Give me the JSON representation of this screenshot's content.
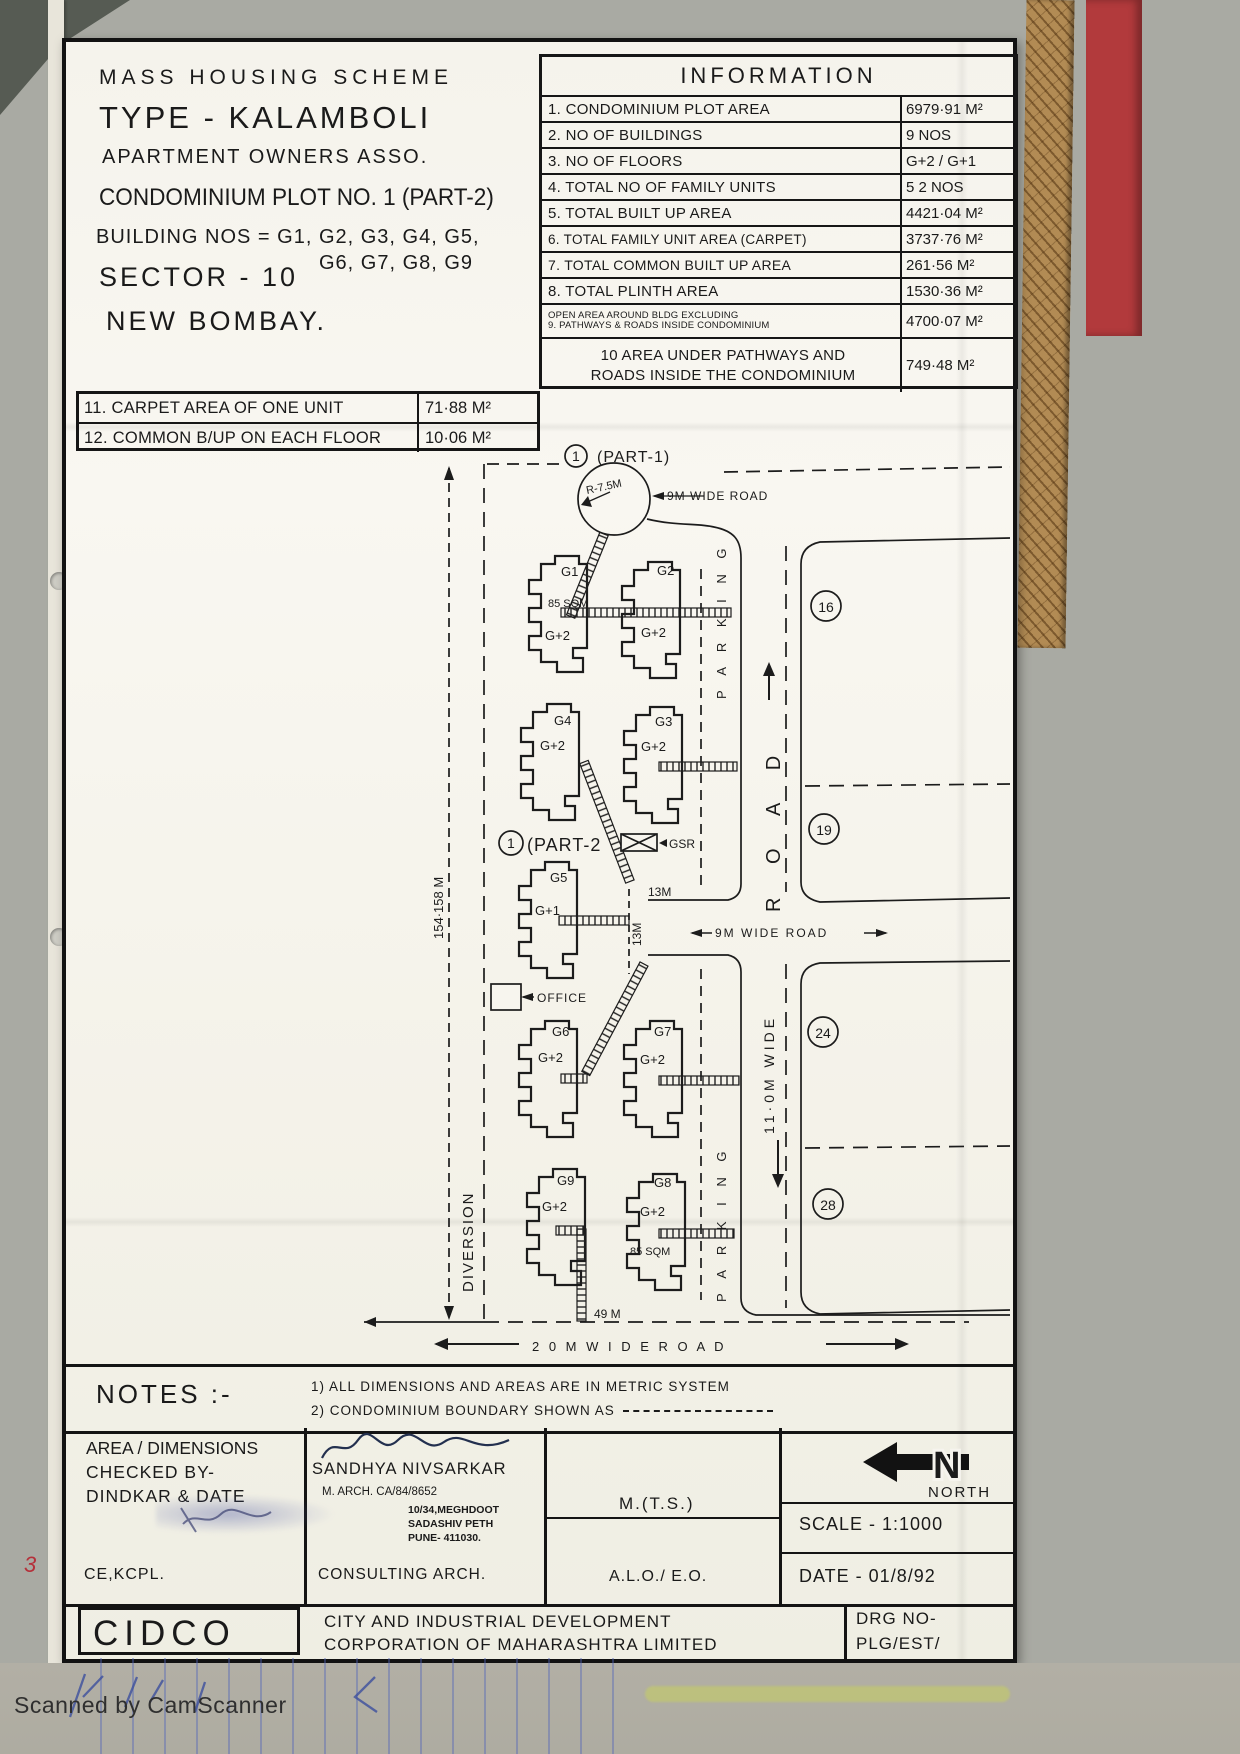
{
  "header": {
    "scheme": "MASS  HOUSING  SCHEME",
    "type": "TYPE - KALAMBOLI",
    "assoc": "APARTMENT  OWNERS   ASSO.",
    "condo": "CONDOMINIUM  PLOT NO. 1 (PART-2)",
    "building_nos": "BUILDING   NOS = G1, G2, G3, G4, G5,",
    "building_nos2": "G6, G7, G8, G9",
    "sector": "SECTOR - 10",
    "city": "NEW  BOMBAY."
  },
  "information": {
    "title": "INFORMATION",
    "rows": [
      {
        "label": "1. CONDOMINIUM  PLOT  AREA",
        "value": "6979·91 M²"
      },
      {
        "label": "2. NO  OF  BUILDINGS",
        "value": "9  NOS"
      },
      {
        "label": "3. NO  OF  FLOORS",
        "value": "G+2 / G+1"
      },
      {
        "label": "4. TOTAL  NO  OF  FAMILY UNITS",
        "value": "5 2  NOS"
      },
      {
        "label": "5. TOTAL  BUILT  UP  AREA",
        "value": "4421·04 M²"
      },
      {
        "label": "6. TOTAL FAMILY UNIT AREA (CARPET)",
        "value": "3737·76 M²"
      },
      {
        "label": "7. TOTAL  COMMON  BUILT UP  AREA",
        "value": "261·56 M²"
      },
      {
        "label": "8. TOTAL  PLINTH  AREA",
        "value": "1530·36 M²"
      }
    ],
    "row9": {
      "l1": "OPEN AREA AROUND BLDG EXCLUDING",
      "l2": "9. PATHWAYS & ROADS INSIDE CONDOMINIUM",
      "value": "4700·07 M²"
    },
    "row10": {
      "l1": "10  AREA  UNDER  PATHWAYS  AND",
      "l2": "ROADS INSIDE THE CONDOMINIUM",
      "value": "749·48 M²"
    },
    "row11": {
      "label": "11. CARPET  AREA  OF  ONE  UNIT",
      "value": "71·88  M²"
    },
    "row12": {
      "label": "12. COMMON  B/UP ON  EACH  FLOOR",
      "value": "10·06  M²"
    }
  },
  "plan": {
    "part1_num": "1",
    "part1": "(PART-1)",
    "part2_num": "1",
    "part2": "(PART-2",
    "radius": "R-7.5M",
    "road_top": "9M WIDE  ROAD",
    "road_mid": "9M  WIDE  ROAD",
    "road_word": "R  O  A  D",
    "road_width": "11·0M  WIDE",
    "road_bottom": "2 0 M   W I D E   R O A D",
    "parking": "P A R K I N G",
    "diversion": "DIVERSION",
    "dim_left": "154·158 M",
    "m13h": "13M",
    "m13v": "13M",
    "m49": "49 M",
    "gsr": "GSR",
    "office": "OFFICE",
    "plot16": "16",
    "plot19": "19",
    "plot24": "24",
    "plot28": "28",
    "buildings": [
      {
        "id": "G1",
        "floors": "G+2",
        "area": "85 SQM"
      },
      {
        "id": "G2",
        "floors": "G+2"
      },
      {
        "id": "G4",
        "floors": "G+2"
      },
      {
        "id": "G3",
        "floors": "G+2"
      },
      {
        "id": "G5",
        "floors": "G+1"
      },
      {
        "id": "G6",
        "floors": "G+2"
      },
      {
        "id": "G7",
        "floors": "G+2"
      },
      {
        "id": "G9",
        "floors": "G+2"
      },
      {
        "id": "G8",
        "floors": "G+2",
        "area": "85 SQM"
      }
    ]
  },
  "notes": {
    "label": "NOTES :-",
    "n1": "1) ALL  DIMENSIONS  AND  AREAS  ARE  IN  METRIC   SYSTEM",
    "n2": "2) CONDOMINIUM  BOUNDARY  SHOWN  AS"
  },
  "titleblock": {
    "checked1": "AREA / DIMENSIONS",
    "checked2": "CHECKED  BY-",
    "checked3": "DINDKAR & DATE",
    "checked_sign": "CE,KCPL.",
    "arch_name": "SANDHYA  NIVSARKAR",
    "arch_qual": "M. ARCH.    CA/84/8652",
    "arch_addr1": "10/34,MEGHDOOT",
    "arch_addr2": "SADASHIV PETH",
    "arch_addr3": "PUNE- 411030.",
    "arch_role": "CONSULTING  ARCH.",
    "mts": "M.(T.S.)",
    "alo": "A.L.O./ E.O.",
    "north_n": "N",
    "north": "NORTH",
    "scale": "SCALE  -  1:1000",
    "date": "DATE   -   01/8/92",
    "org_abbr": "CIDCO",
    "org1": "CITY  AND  INDUSTRIAL  DEVELOPMENT",
    "org2": "CORPORATION  OF  MAHARASHTRA  LIMITED",
    "drg1": "DRG NO-",
    "drg2": "PLG/EST/"
  },
  "scan": {
    "footer": "Scanned by CamScanner"
  }
}
